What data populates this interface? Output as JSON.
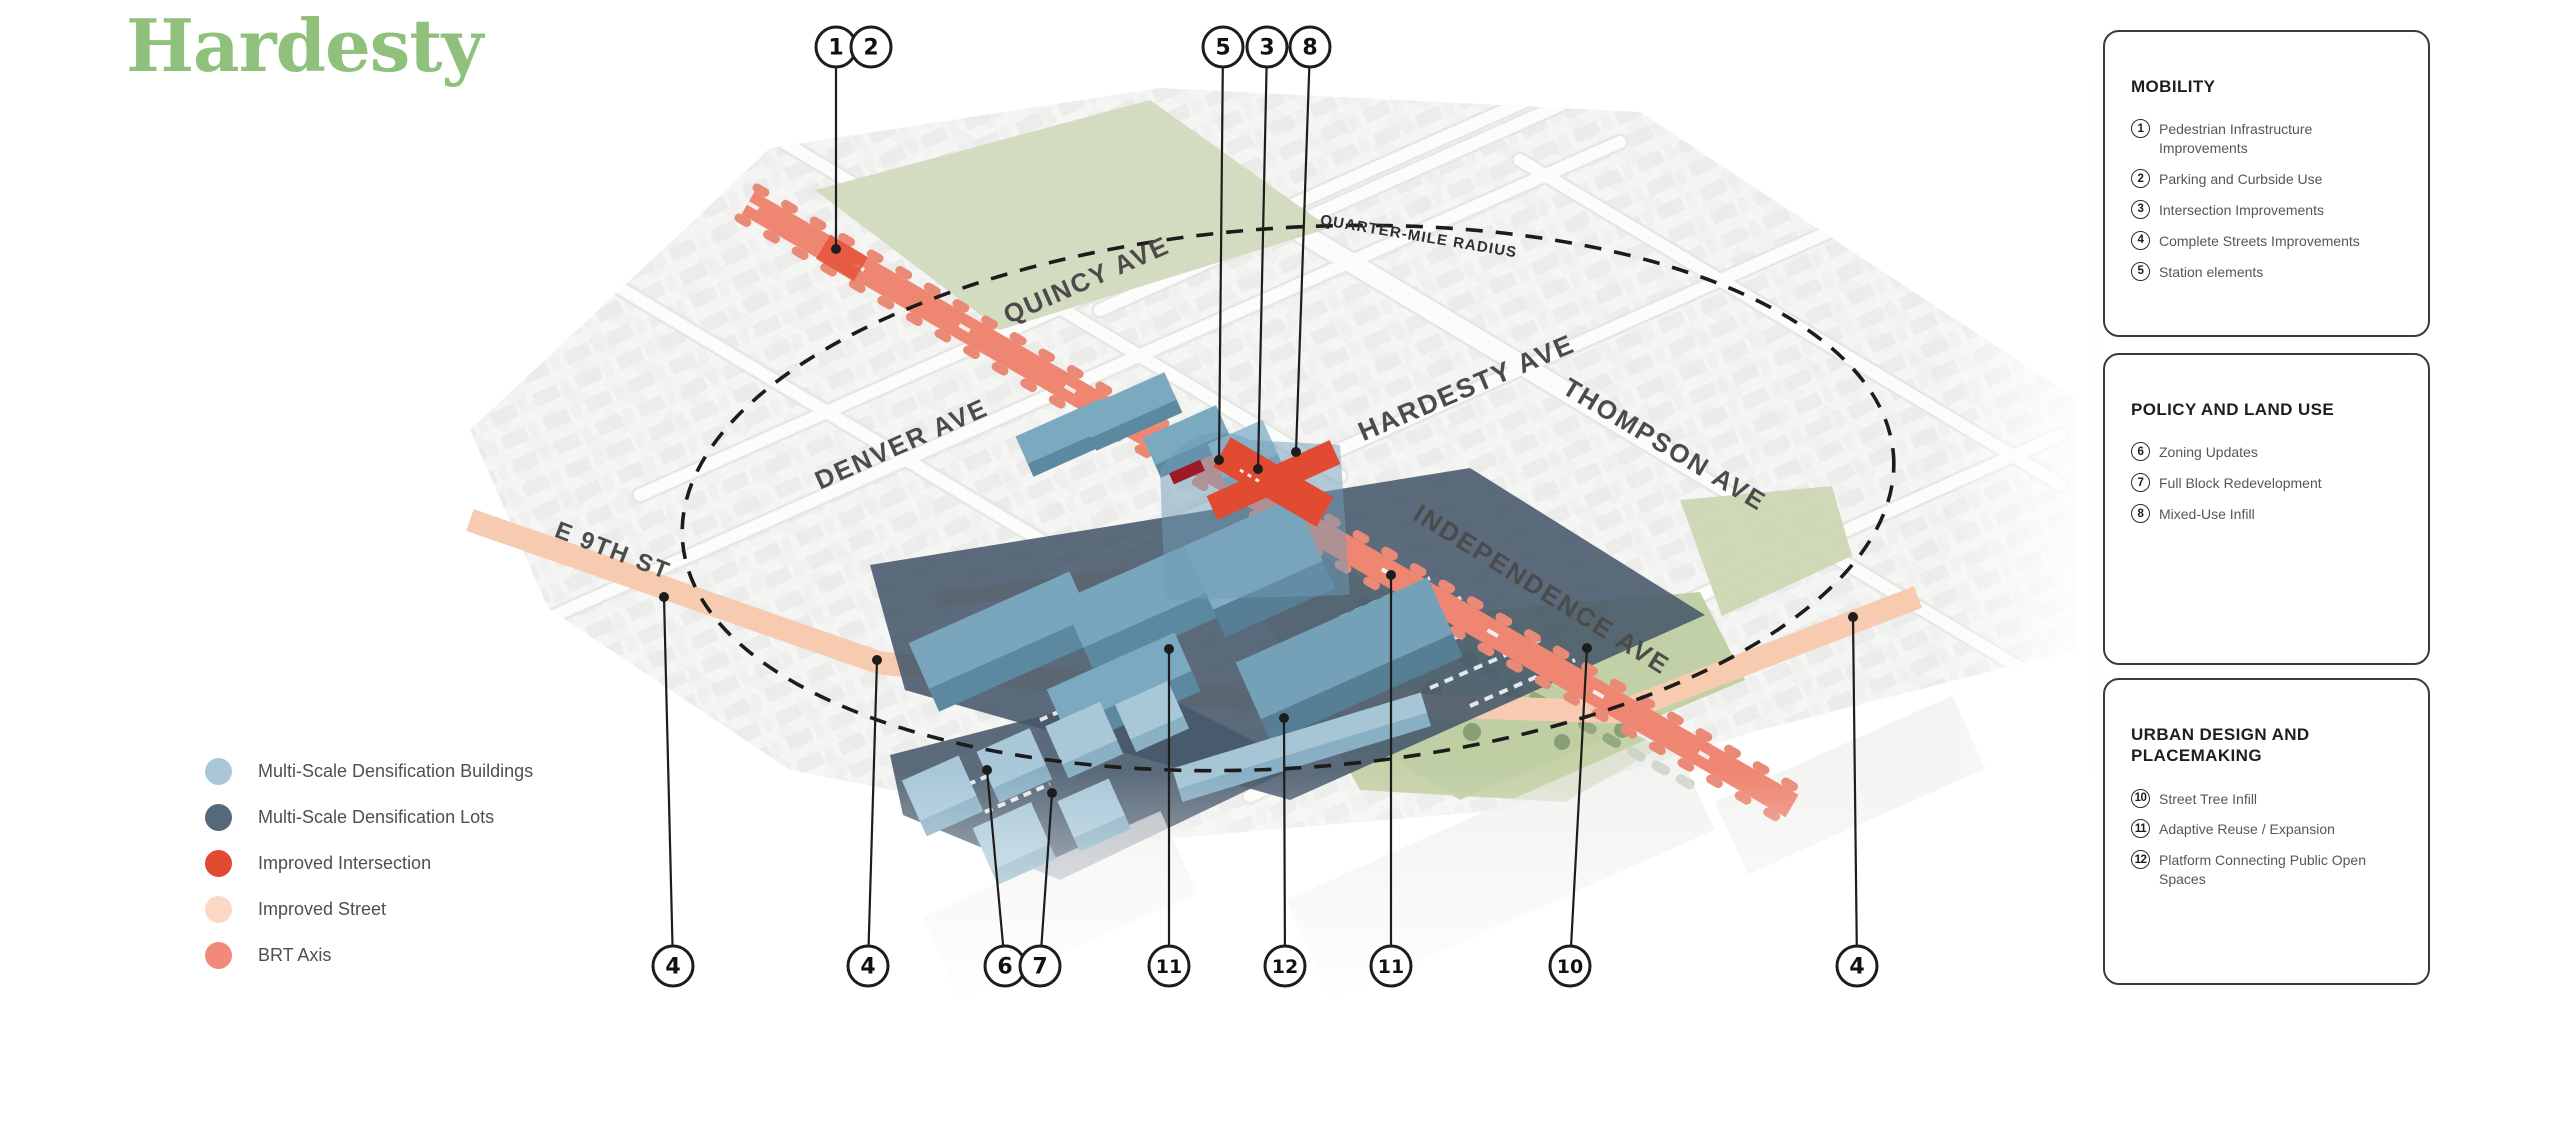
{
  "title": {
    "text": "Hardesty",
    "color": "#8fc17d"
  },
  "map": {
    "radius_label": "QUARTER-MILE RADIUS",
    "streets": [
      {
        "name": "QUINCY AVE"
      },
      {
        "name": "DENVER AVE"
      },
      {
        "name": "HARDESTY AVE"
      },
      {
        "name": "THOMPSON AVE"
      },
      {
        "name": "INDEPENDENCE AVE"
      },
      {
        "name": "E 9TH ST"
      }
    ],
    "callouts": [
      {
        "n": "1",
        "x": 836,
        "y": 47,
        "tx": 836,
        "ty": 249,
        "line": true
      },
      {
        "n": "2",
        "x": 871,
        "y": 47,
        "line": false
      },
      {
        "n": "5",
        "x": 1223,
        "y": 47,
        "tx": 1219,
        "ty": 460,
        "line": true
      },
      {
        "n": "3",
        "x": 1267,
        "y": 47,
        "tx": 1258,
        "ty": 469,
        "line": true
      },
      {
        "n": "8",
        "x": 1310,
        "y": 47,
        "tx": 1296,
        "ty": 452,
        "line": true
      },
      {
        "n": "4",
        "x": 673,
        "y": 966,
        "tx": 664,
        "ty": 597,
        "line": true
      },
      {
        "n": "4",
        "x": 868,
        "y": 966,
        "tx": 877,
        "ty": 660,
        "line": true
      },
      {
        "n": "6",
        "x": 1005,
        "y": 966,
        "tx": 987,
        "ty": 770,
        "line": true
      },
      {
        "n": "7",
        "x": 1040,
        "y": 966,
        "tx": 1052,
        "ty": 793,
        "line": true
      },
      {
        "n": "11",
        "x": 1169,
        "y": 966,
        "tx": 1169,
        "ty": 649,
        "line": true
      },
      {
        "n": "12",
        "x": 1285,
        "y": 966,
        "tx": 1284,
        "ty": 718,
        "line": true
      },
      {
        "n": "11",
        "x": 1391,
        "y": 966,
        "tx": 1391,
        "ty": 575,
        "line": true
      },
      {
        "n": "10",
        "x": 1570,
        "y": 966,
        "tx": 1587,
        "ty": 648,
        "line": true
      },
      {
        "n": "4",
        "x": 1857,
        "y": 966,
        "tx": 1853,
        "ty": 617,
        "line": true
      }
    ]
  },
  "legend": {
    "items": [
      {
        "label": "Multi-Scale Densification Buildings",
        "color": "#aac7d8"
      },
      {
        "label": "Multi-Scale Densification Lots",
        "color": "#55697b"
      },
      {
        "label": "Improved Intersection",
        "color": "#df4a30"
      },
      {
        "label": "Improved Street",
        "color": "#fbd9c4"
      },
      {
        "label": "BRT Axis",
        "color": "#f18a79"
      }
    ]
  },
  "panels": [
    {
      "title": "MOBILITY",
      "items": [
        {
          "n": "1",
          "label": "Pedestrian Infrastructure Improvements"
        },
        {
          "n": "2",
          "label": "Parking and Curbside Use"
        },
        {
          "n": "3",
          "label": "Intersection Improvements"
        },
        {
          "n": "4",
          "label": "Complete Streets Improvements"
        },
        {
          "n": "5",
          "label": "Station elements"
        }
      ]
    },
    {
      "title": "POLICY AND LAND USE",
      "items": [
        {
          "n": "6",
          "label": "Zoning Updates"
        },
        {
          "n": "7",
          "label": "Full Block Redevelopment"
        },
        {
          "n": "8",
          "label": "Mixed-Use Infill"
        }
      ]
    },
    {
      "title": "URBAN DESIGN AND PLACEMAKING",
      "items": [
        {
          "n": "10",
          "label": "Street Tree Infill"
        },
        {
          "n": "11",
          "label": "Adaptive Reuse / Expansion"
        },
        {
          "n": "12",
          "label": "Platform Connecting Public Open Spaces"
        }
      ]
    }
  ]
}
